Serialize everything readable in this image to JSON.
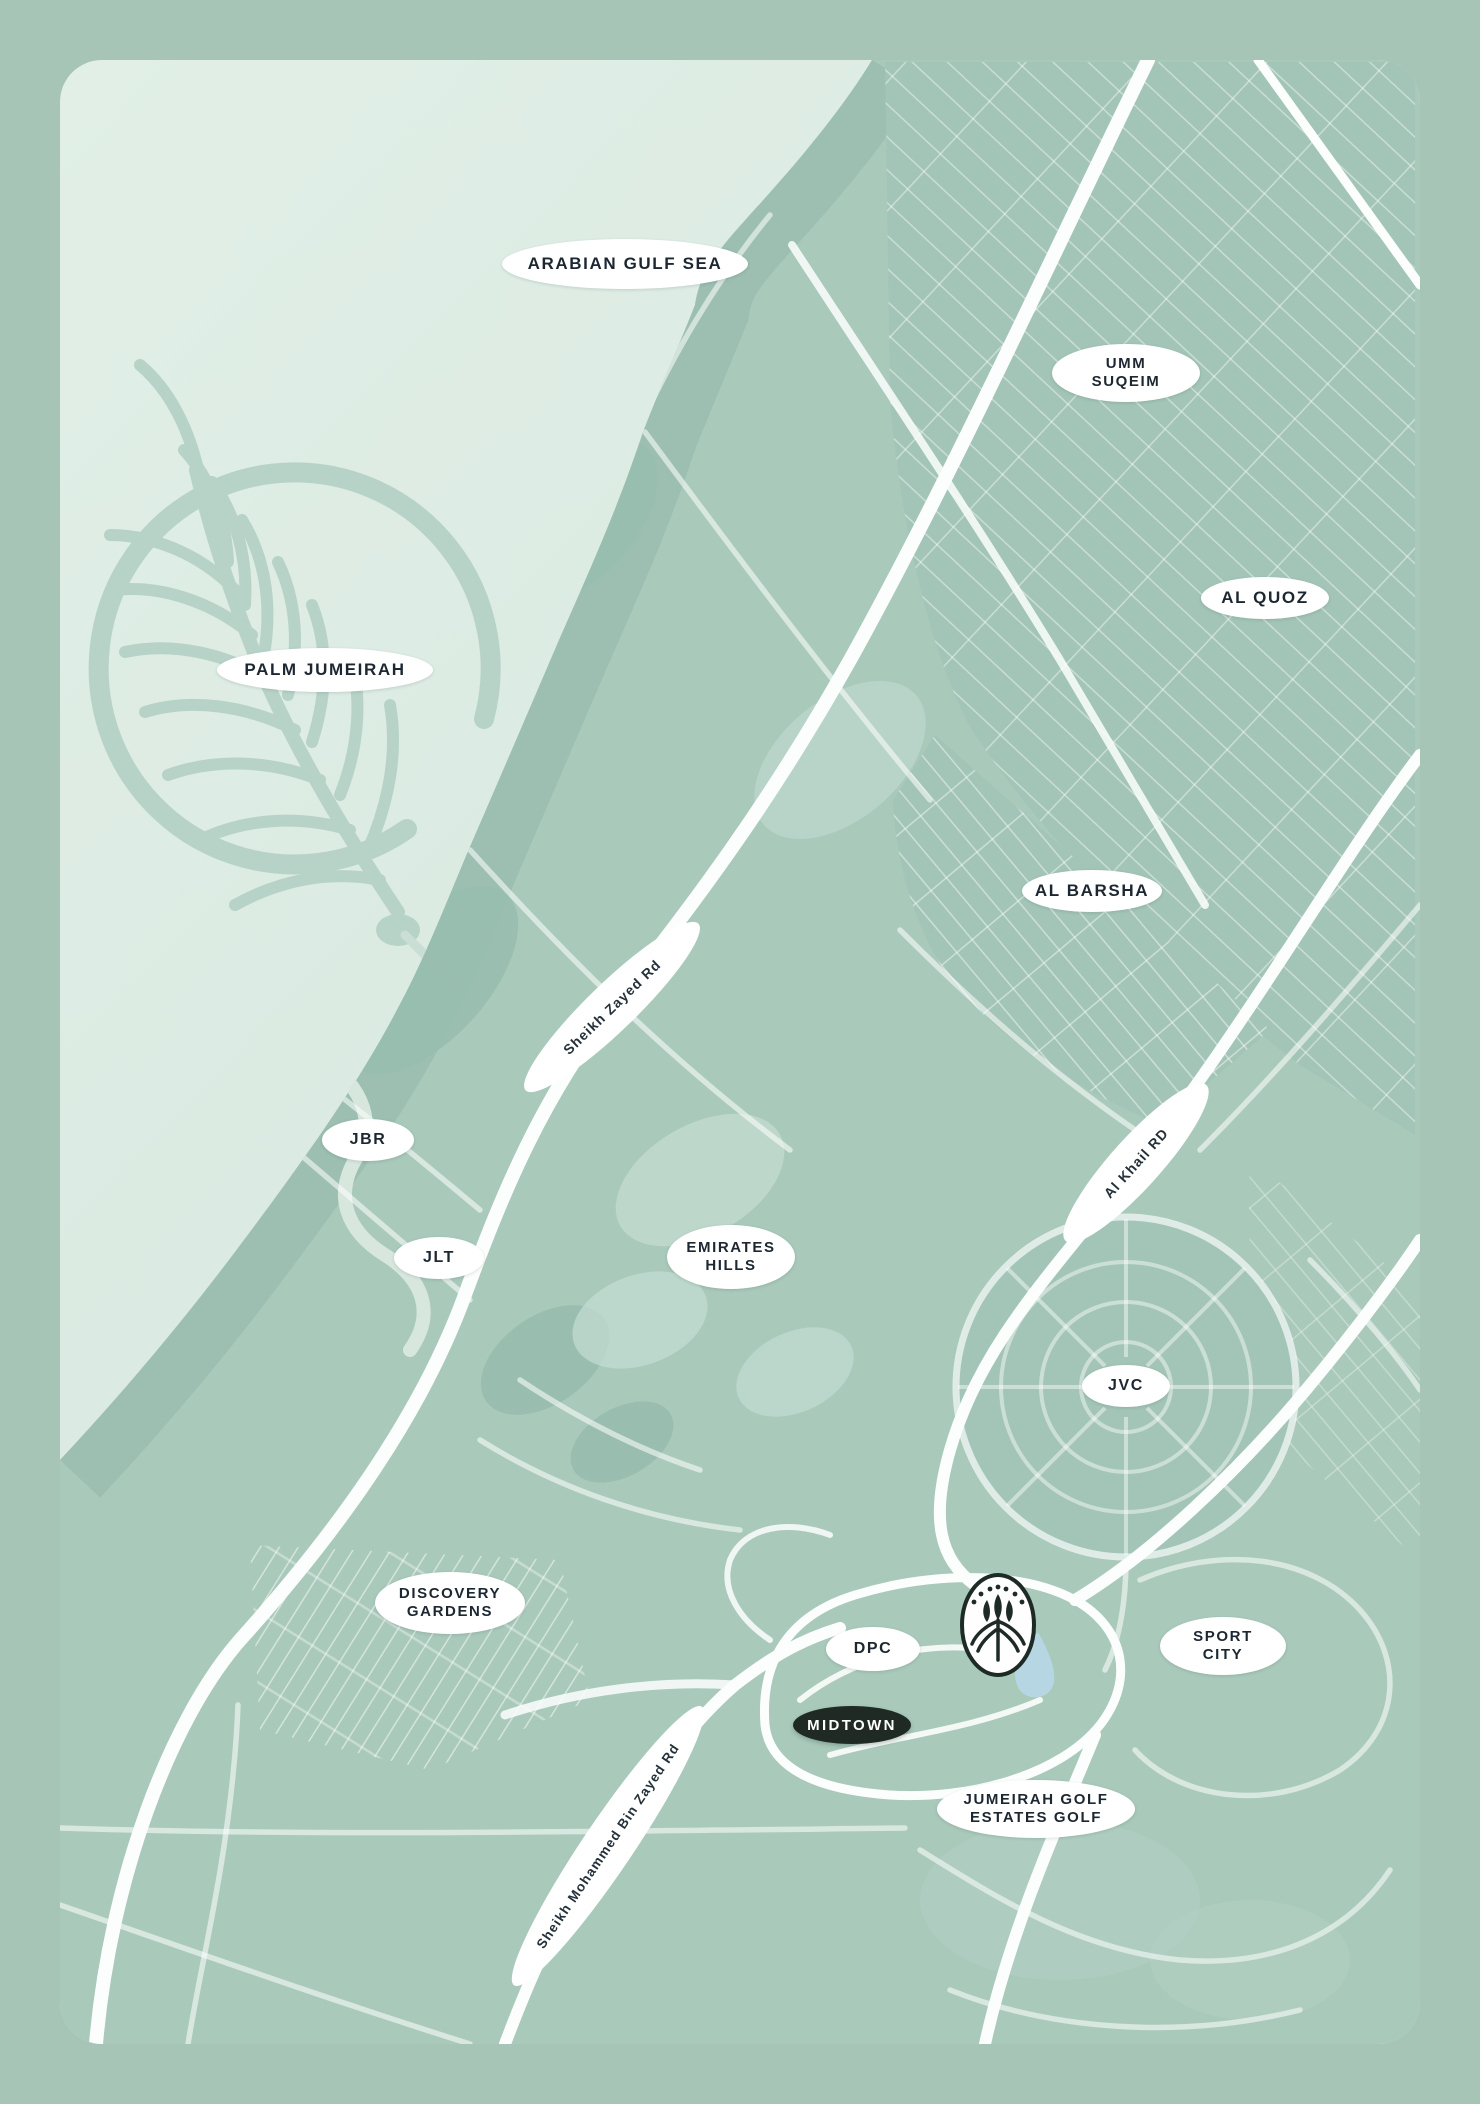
{
  "map": {
    "title": "Dubai area location map",
    "colors": {
      "frame": "#a6c5b7",
      "sea": "#dbe9e1",
      "land": "#a9c9bb",
      "coast_band": "#98bdaf",
      "street_light": "#d2e4da",
      "road_white": "#fcfefd",
      "label_bg": "#ffffff",
      "label_text": "#1c2732",
      "project_bg": "#1f2a25",
      "project_text": "#ffffff",
      "lake": "#b5d6e2",
      "palm": "#b7d3c7"
    },
    "area_labels": [
      {
        "id": "arabian-gulf-sea",
        "text": "ARABIAN GULF SEA"
      },
      {
        "id": "umm-suqeim",
        "text": "UMM\nSUQEIM"
      },
      {
        "id": "al-quoz",
        "text": "AL QUOZ"
      },
      {
        "id": "palm-jumeirah",
        "text": "PALM JUMEIRAH"
      },
      {
        "id": "al-barsha",
        "text": "AL BARSHA"
      },
      {
        "id": "jbr",
        "text": "JBR"
      },
      {
        "id": "jlt",
        "text": "JLT"
      },
      {
        "id": "emirates-hills",
        "text": "EMIRATES\nHILLS"
      },
      {
        "id": "jvc",
        "text": "JVC"
      },
      {
        "id": "discovery-gardens",
        "text": "DISCOVERY\nGARDENS"
      },
      {
        "id": "dpc",
        "text": "DPC"
      },
      {
        "id": "sport-city",
        "text": "SPORT\nCITY"
      },
      {
        "id": "jumeirah-golf-estates",
        "text": "JUMEIRAH GOLF\nESTATES GOLF"
      }
    ],
    "road_labels": [
      {
        "id": "sheikh-zayed-rd",
        "text": "Sheikh Zayed Rd"
      },
      {
        "id": "al-khail-rd",
        "text": "Al Khail RD"
      },
      {
        "id": "sheikh-mohammed-bin-zayed-rd",
        "text": "Sheikh Mohammed Bin Zayed Rd"
      }
    ],
    "project_label": {
      "text": "MIDTOWN"
    },
    "emblem": {
      "name": "midtown-brand-emblem"
    }
  }
}
